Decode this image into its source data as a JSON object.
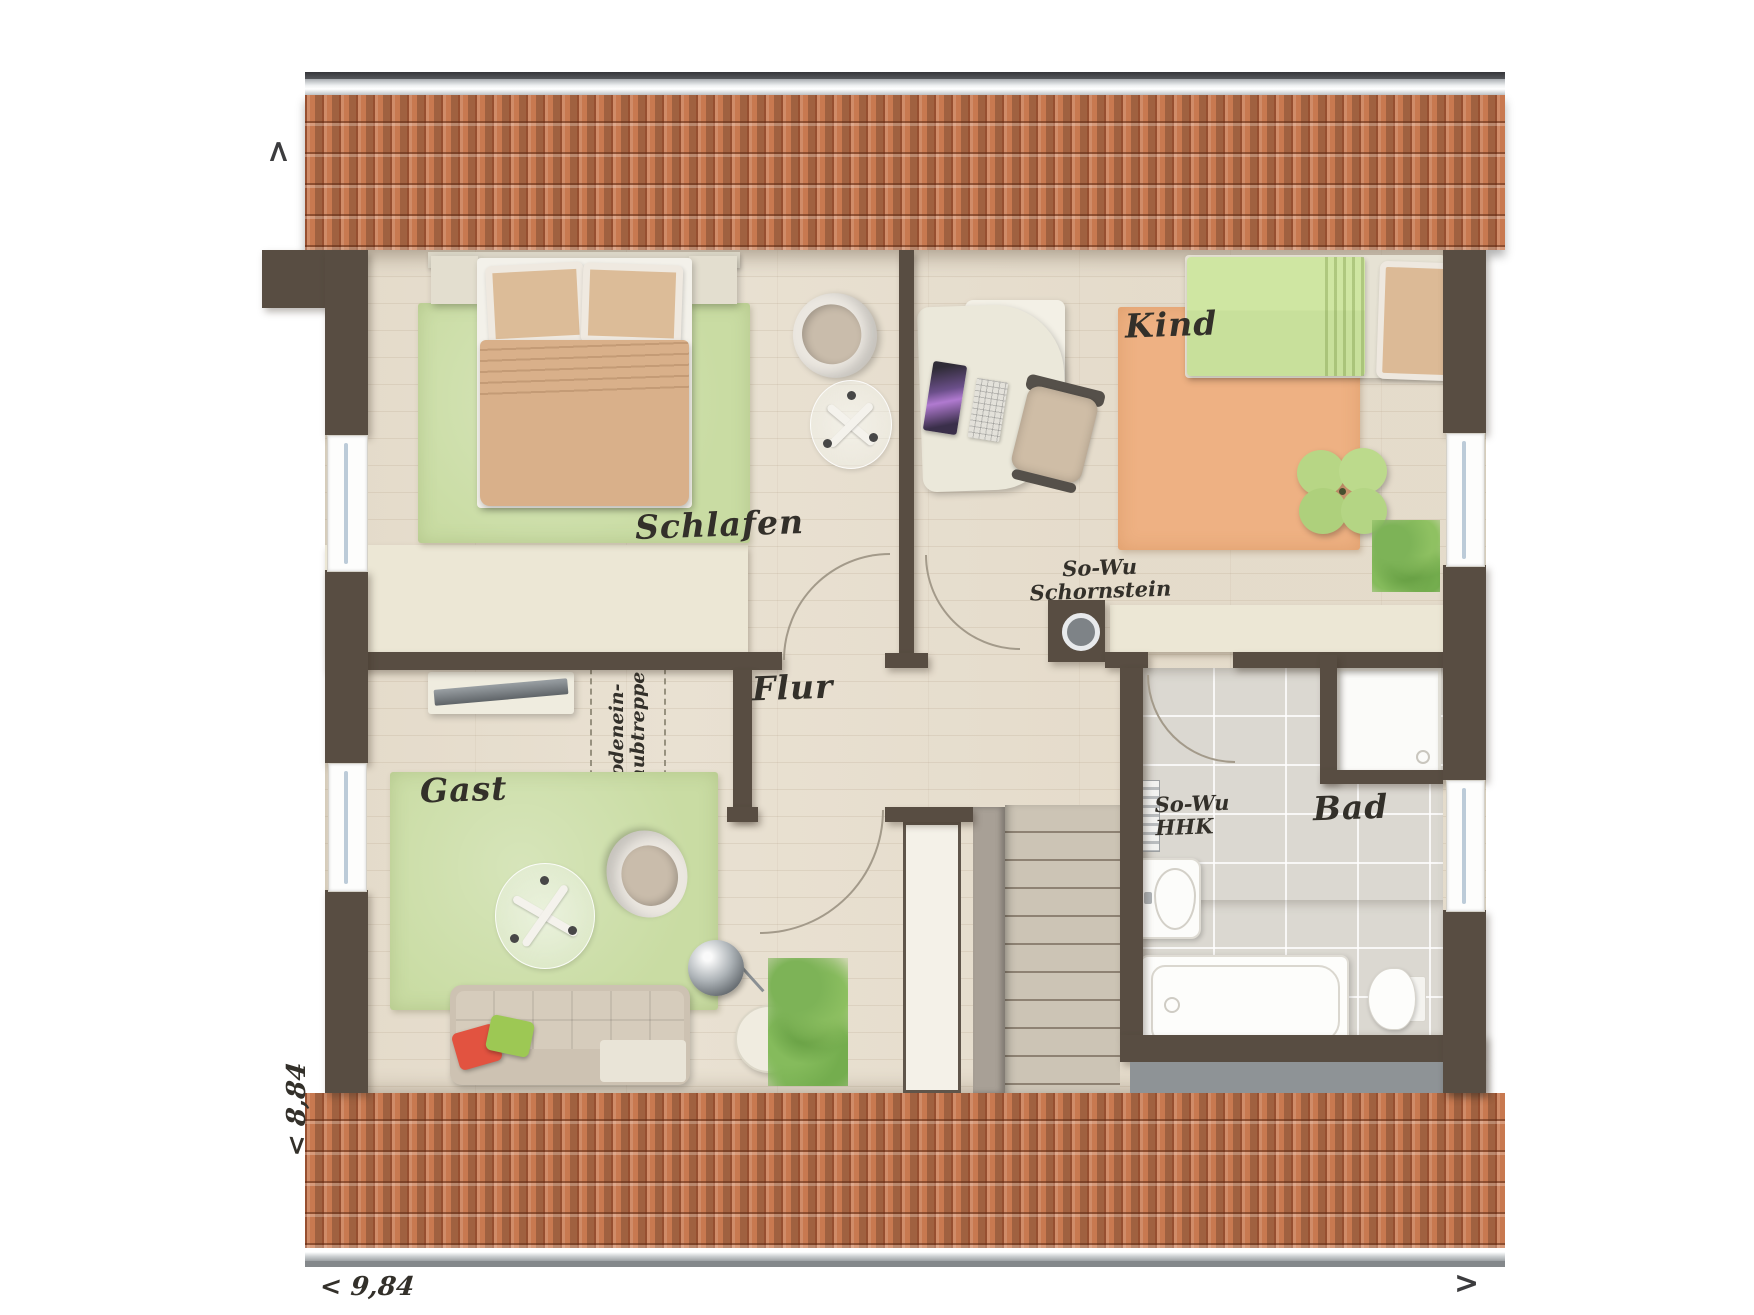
{
  "rooms": {
    "schlafen": "Schlafen",
    "kind": "Kind",
    "flur": "Flur",
    "gast": "Gast",
    "bad": "Bad"
  },
  "annotations": {
    "chimney": {
      "line1": "So-Wu",
      "line2": "Schornstein"
    },
    "heater": {
      "line1": "So-Wu",
      "line2": "HHK"
    },
    "loft_ladder": {
      "line1": "Bodenein-",
      "line2": "schubtreppe"
    }
  },
  "dimensions": {
    "width": "< 9,84",
    "depth": "< 8,84"
  },
  "arrows": {
    "top": ">",
    "bottom_right": ">"
  },
  "colors": {
    "roof": "#c87950",
    "walls": "#584d42",
    "knee_wall": "#ece7d5",
    "wood_floor": "#e9e1d2",
    "tile_floor": "#dbd8d1",
    "rug_green": "#c9dca3",
    "rug_orange": "#eeb183",
    "pillow_red": "#e25340",
    "pillow_green": "#9dc854"
  }
}
